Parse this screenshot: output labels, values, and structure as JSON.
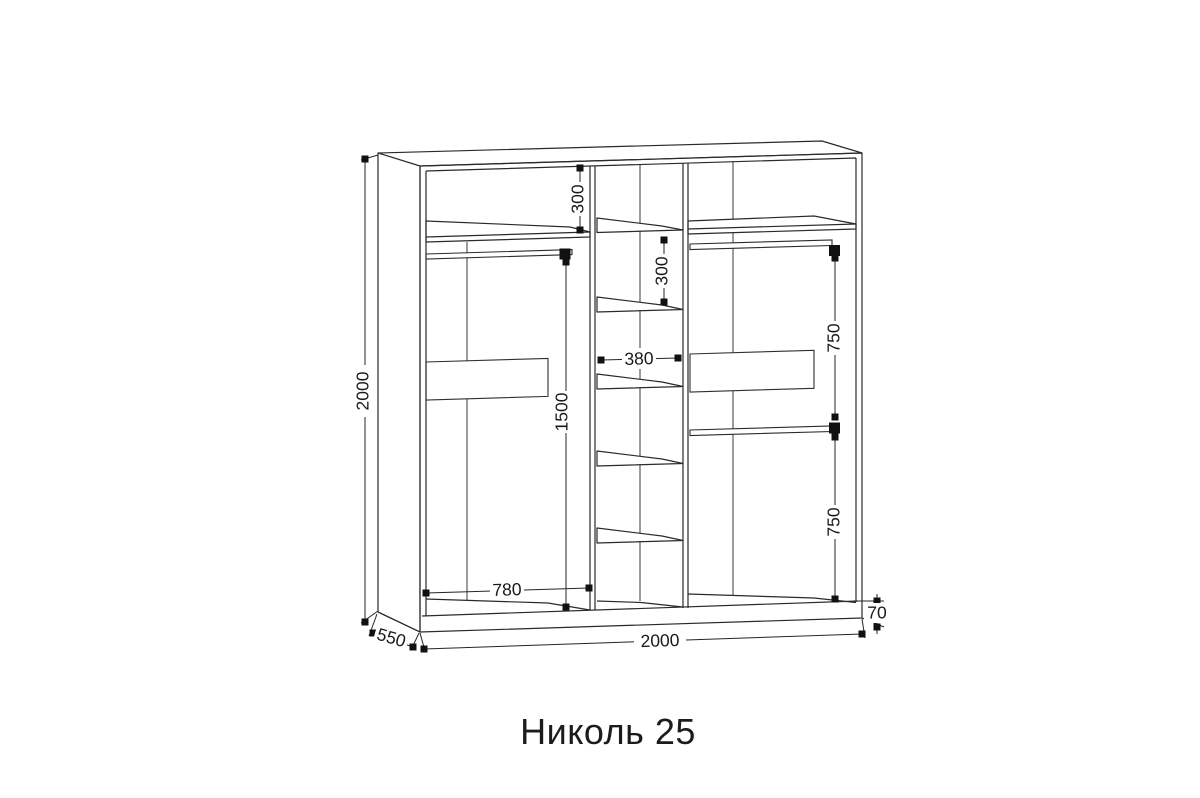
{
  "title": "Николь 25",
  "dims": {
    "overall_height": "2000",
    "overall_width": "2000",
    "depth": "550",
    "plinth_height": "70",
    "left_section_width": "780",
    "rod_to_floor": "1500",
    "top_shelf_offset": "300",
    "middle_shelf_gap": "300",
    "middle_section_width": "380",
    "right_upper_section": "750",
    "right_lower_section": "750"
  }
}
